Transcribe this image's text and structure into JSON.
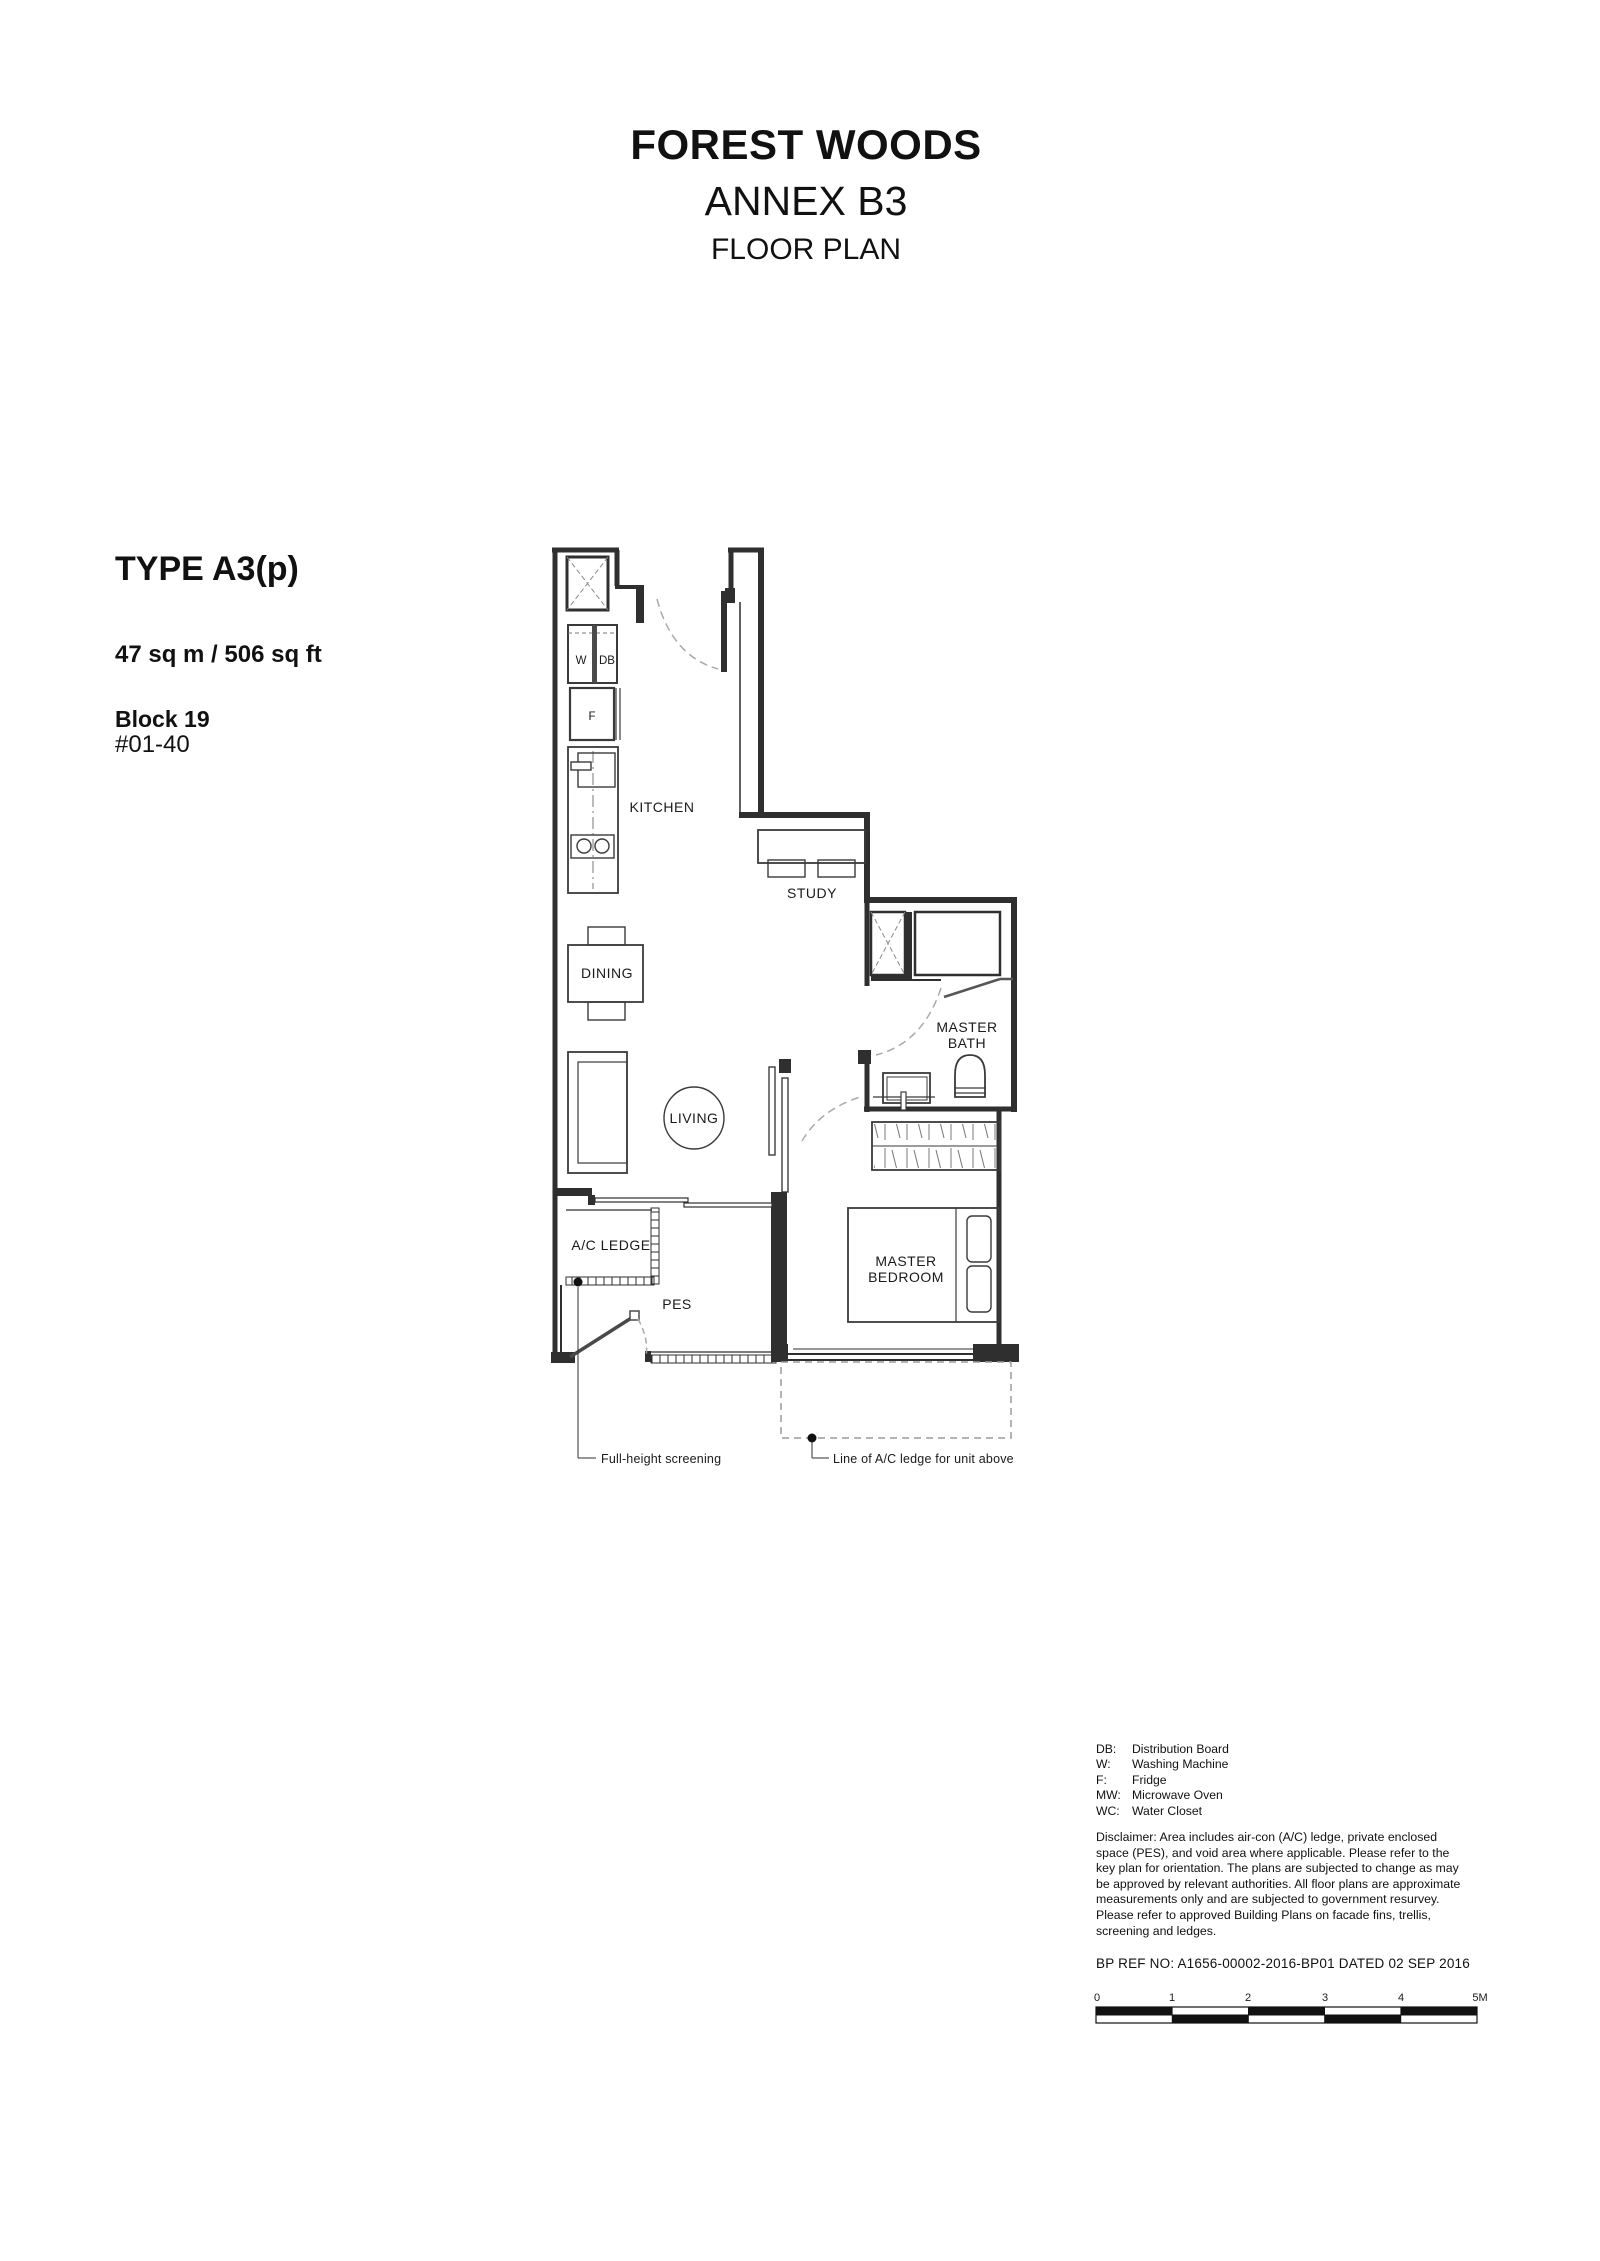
{
  "header": {
    "project": "FOREST WOODS",
    "annex": "ANNEX B3",
    "doc_type": "FLOOR PLAN"
  },
  "unit": {
    "type": "TYPE A3(p)",
    "area": "47 sq m / 506 sq ft",
    "block": "Block 19",
    "unit_no": "#01-40"
  },
  "plan": {
    "rooms": {
      "kitchen": "KITCHEN",
      "study": "STUDY",
      "dining": "DINING",
      "living": "LIVING",
      "master_bath": [
        "MASTER",
        "BATH"
      ],
      "master_bedroom": [
        "MASTER",
        "BEDROOM"
      ],
      "ac_ledge": "A/C LEDGE",
      "pes": "PES"
    },
    "appliances": {
      "w": "W",
      "db": "DB",
      "f": "F"
    },
    "callouts": {
      "full_height_screening": "Full-height screening",
      "ac_ledge_above": "Line of A/C ledge for unit above"
    }
  },
  "legend": {
    "items": [
      {
        "abbr": "DB:",
        "label": "Distribution Board"
      },
      {
        "abbr": "W:",
        "label": "Washing Machine"
      },
      {
        "abbr": "F:",
        "label": "Fridge"
      },
      {
        "abbr": "MW:",
        "label": "Microwave Oven"
      },
      {
        "abbr": "WC:",
        "label": "Water Closet"
      }
    ]
  },
  "disclaimer": {
    "text": "Disclaimer: Area includes air-con (A/C) ledge, private enclosed\nspace (PES), and void area where applicable.  Please refer to the\nkey plan for orientation.  The plans are subjected to change as may\nbe approved by relevant authorities.  All floor plans are approximate\nmeasurements only and are subjected to government resurvey.\nPlease refer to approved Building Plans on facade fins, trellis,\nscreening and ledges."
  },
  "bp_ref": {
    "text": "BP REF NO:  A1656-00002-2016-BP01 DATED 02 SEP 2016"
  },
  "scale_bar": {
    "labels": [
      "0",
      "1",
      "2",
      "3",
      "4",
      "5M"
    ]
  }
}
